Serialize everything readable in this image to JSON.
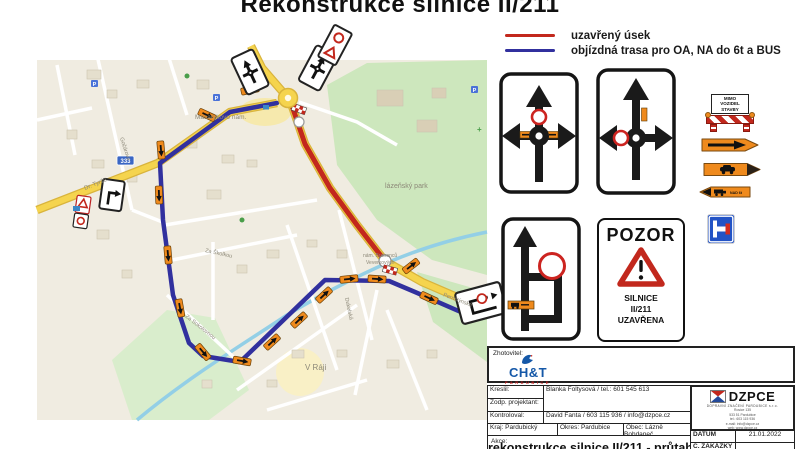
{
  "title": "Rekonstrukce silnice II/211",
  "legend": {
    "closed_label": "uzavřený úsek",
    "closed_color": "#c2281d",
    "detour_label": "objízdná trasa pro OA, NA do 6t a BUS",
    "detour_color": "#31309e"
  },
  "map": {
    "road_number": "333",
    "labels": {
      "square": "Masarykovo nám.",
      "park": "lázeňský park",
      "tyrse": "Dr. Tyrše",
      "gocarova": "Gočárova",
      "sokolovnou": "Za Sokolovnou",
      "skolkou": "Za Školkou",
      "dukelska": "Dukelská",
      "vraji": "V Ráji",
      "bratrancu": "nám. Bratranců",
      "veverkovych": "Veverkových",
      "pernstynska": "Pernštýnská"
    }
  },
  "signs": {
    "barrier": {
      "line1": "MIMO",
      "line2": "VOZIDEL",
      "line3": "STAVBY"
    },
    "truck_arrow_label": "NAD 6t",
    "pozor": {
      "title": "POZOR",
      "line1": "SILNICE",
      "line2": "II/211",
      "line3": "UZAVŘENA"
    }
  },
  "titleblock": {
    "zhotovitel_label": "Zhotovitel:",
    "cht_name": "CH&T",
    "cht_sub": "PARDUBICE",
    "kreslil_label": "Kreslil:",
    "zodp_label": "Zodp. projektant:",
    "kreslil_value": "Blanka Foltysová / tel.: 601 545 613",
    "kontroloval_label": "Kontroloval:",
    "kontroloval_value": "David Fanta / 603 115 936 / info@dzpce.cz",
    "kraj": "Kraj: Pardubický",
    "okres": "Okres: Pardubice",
    "obec": "Obec: Lázně Bohdaneč",
    "akce_label": "Akce:",
    "akce_value": "rekonstrukce silnice II/211 - průtah",
    "dzpce_name": "DZPCE",
    "dzpce_subtitle": "DOPRAVNÍ ZNAČENÍ PARDUBICE s.r.o.",
    "dzpce_address": [
      "Rosice 135",
      "533 51 Pardubice",
      "tel.: 603 115 936",
      "e-mail: info@dzpce.cz",
      "web: www.dzpce.cz"
    ],
    "datum_label": "DATUM",
    "datum_value": "21.01.2022",
    "zakazka_label": "Č. ZAKÁZKY"
  }
}
